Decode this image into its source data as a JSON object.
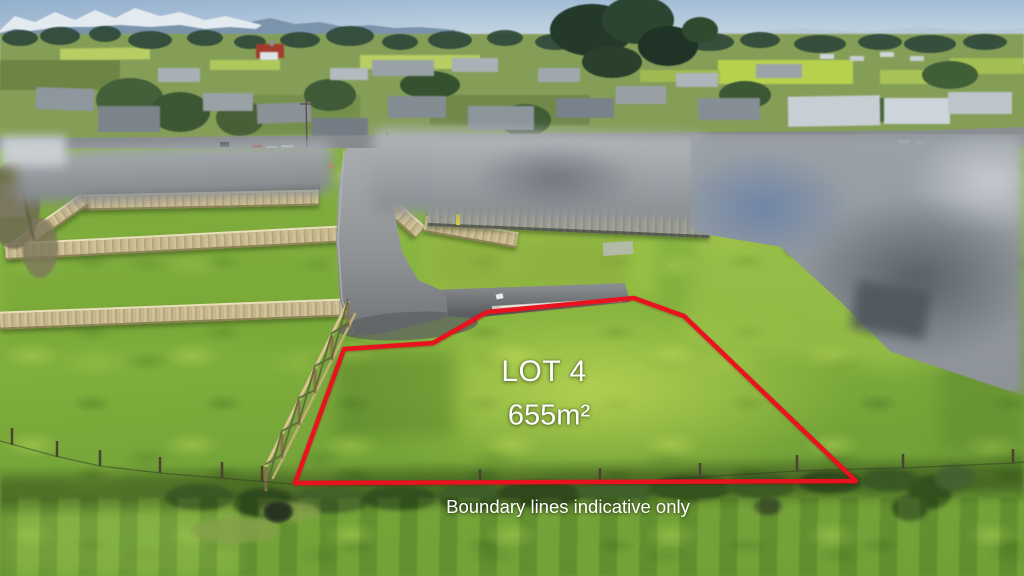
{
  "overlay": {
    "lot_label": "LOT 4",
    "lot_area": "655m²",
    "disclaimer": "Boundary lines indicative only",
    "text_color": "#ffffff"
  },
  "boundary": {
    "points": "295,483 344,349 433,343 487,312 634,298 684,316 856,481",
    "stroke_color": "#e8131f",
    "stroke_width": "4.5"
  }
}
